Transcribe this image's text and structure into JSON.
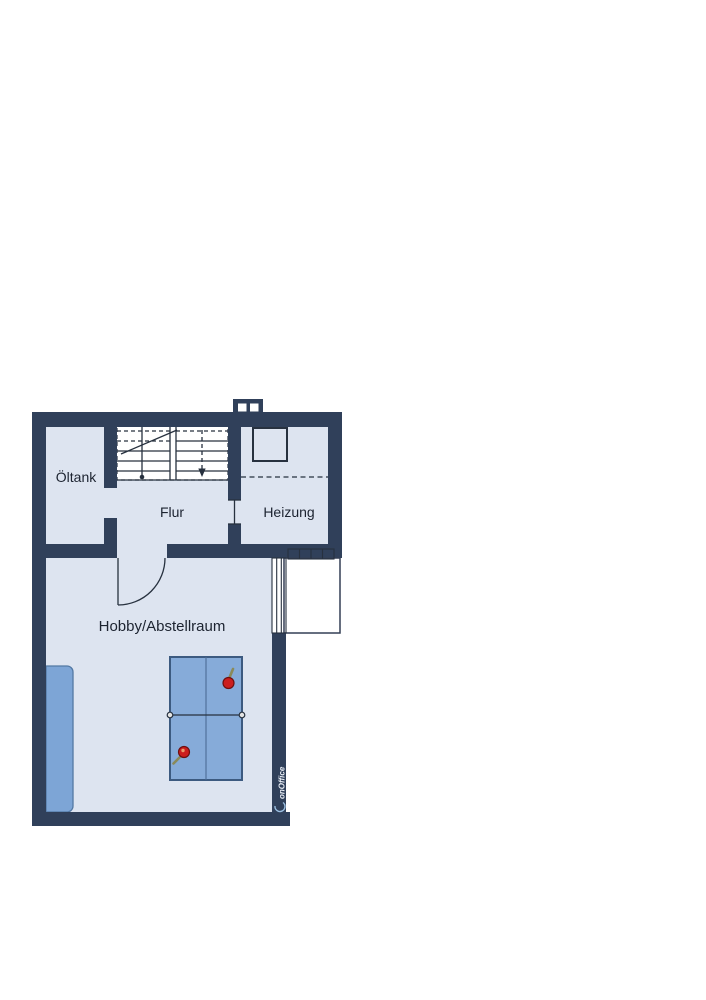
{
  "floor_plan": {
    "rooms": [
      {
        "id": "oeltank",
        "label": "Öltank"
      },
      {
        "id": "flur",
        "label": "Flur"
      },
      {
        "id": "heizung",
        "label": "Heizung"
      },
      {
        "id": "hobby",
        "label": "Hobby/Abstellraum"
      }
    ],
    "watermark": "onOffice"
  },
  "colors": {
    "wall": "#30405a",
    "roomFill": "#dde4f0",
    "lineCol": "#27313f",
    "textCol": "#1c2330",
    "furn": "#7da5d6",
    "furnBorder": "#5379a4",
    "tableBlue": "#86abd9",
    "tableBorder": "#3c5a80",
    "tableLine": "#4c6c96",
    "paddleRed": "#cc1e1e",
    "paddleBorder": "#6e0f0f",
    "handleCol": "#8a8a5a",
    "wmText": "#e9eef6",
    "wmSwoosh": "#9cc0e2"
  }
}
